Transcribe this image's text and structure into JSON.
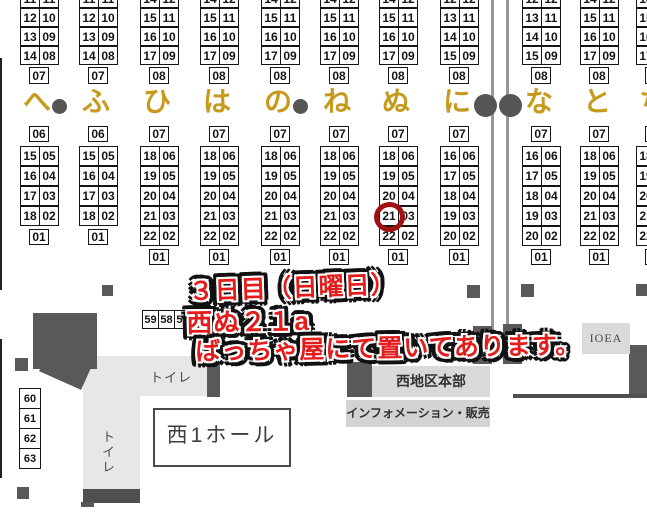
{
  "hall_map": {
    "accent_gold": "#c69b1d",
    "row_labels": [
      {
        "kana": "へ",
        "pillar_dot_after": true
      },
      {
        "kana": "ふ",
        "pillar_dot_after": false
      },
      {
        "kana": "ひ",
        "pillar_dot_after": false
      },
      {
        "kana": "は",
        "pillar_dot_after": false
      },
      {
        "kana": "の",
        "pillar_dot_after": true
      },
      {
        "kana": "ね",
        "pillar_dot_after": false
      },
      {
        "kana": "ぬ",
        "pillar_dot_after": false
      },
      {
        "kana": "に",
        "pillar_dot_after": false
      },
      {
        "kana": "な",
        "pillar_dot_after": false
      },
      {
        "kana": "と",
        "pillar_dot_after": false
      },
      {
        "kana": "ち",
        "pillar_dot_after": false
      }
    ],
    "columns": [
      {
        "kana": "へ",
        "upper": {
          "cut_pair": [
            "11",
            "11"
          ],
          "pairs": [
            [
              "12",
              "10"
            ],
            [
              "13",
              "09"
            ],
            [
              "14",
              "08"
            ]
          ],
          "foot": "07"
        },
        "lower": {
          "head": "06",
          "pairs": [
            [
              "15",
              "05"
            ],
            [
              "16",
              "04"
            ],
            [
              "17",
              "03"
            ],
            [
              "18",
              "02"
            ]
          ],
          "foot": "01"
        }
      },
      {
        "kana": "ふ",
        "upper": {
          "cut_pair": [
            "11",
            "11"
          ],
          "pairs": [
            [
              "12",
              "10"
            ],
            [
              "13",
              "09"
            ],
            [
              "14",
              "08"
            ]
          ],
          "foot": "07"
        },
        "lower": {
          "head": "06",
          "pairs": [
            [
              "15",
              "05"
            ],
            [
              "16",
              "04"
            ],
            [
              "17",
              "03"
            ],
            [
              "18",
              "02"
            ]
          ],
          "foot": "01"
        }
      },
      {
        "kana": "ひ",
        "upper": {
          "cut_pair": [
            "14",
            "12"
          ],
          "pairs": [
            [
              "15",
              "11"
            ],
            [
              "16",
              "10"
            ],
            [
              "17",
              "09"
            ]
          ],
          "foot": "08"
        },
        "lower": {
          "head": "07",
          "pairs": [
            [
              "18",
              "06"
            ],
            [
              "19",
              "05"
            ],
            [
              "20",
              "04"
            ],
            [
              "21",
              "03"
            ],
            [
              "22",
              "02"
            ]
          ],
          "foot": "01"
        }
      },
      {
        "kana": "は",
        "upper": {
          "cut_pair": [
            "14",
            "12"
          ],
          "pairs": [
            [
              "15",
              "11"
            ],
            [
              "16",
              "10"
            ],
            [
              "17",
              "09"
            ]
          ],
          "foot": "08"
        },
        "lower": {
          "head": "07",
          "pairs": [
            [
              "18",
              "06"
            ],
            [
              "19",
              "05"
            ],
            [
              "20",
              "04"
            ],
            [
              "21",
              "03"
            ],
            [
              "22",
              "02"
            ]
          ],
          "foot": "01"
        }
      },
      {
        "kana": "の",
        "upper": {
          "cut_pair": [
            "14",
            "12"
          ],
          "pairs": [
            [
              "15",
              "11"
            ],
            [
              "16",
              "10"
            ],
            [
              "17",
              "09"
            ]
          ],
          "foot": "08"
        },
        "lower": {
          "head": "07",
          "pairs": [
            [
              "18",
              "06"
            ],
            [
              "19",
              "05"
            ],
            [
              "20",
              "04"
            ],
            [
              "21",
              "03"
            ],
            [
              "22",
              "02"
            ]
          ],
          "foot": "01"
        }
      },
      {
        "kana": "ね",
        "upper": {
          "cut_pair": [
            "14",
            "12"
          ],
          "pairs": [
            [
              "15",
              "11"
            ],
            [
              "16",
              "10"
            ],
            [
              "17",
              "09"
            ]
          ],
          "foot": "08"
        },
        "lower": {
          "head": "07",
          "pairs": [
            [
              "18",
              "06"
            ],
            [
              "19",
              "05"
            ],
            [
              "20",
              "04"
            ],
            [
              "21",
              "03"
            ],
            [
              "22",
              "02"
            ]
          ],
          "foot": "01"
        }
      },
      {
        "kana": "ぬ",
        "upper": {
          "cut_pair": [
            "14",
            "12"
          ],
          "pairs": [
            [
              "15",
              "11"
            ],
            [
              "16",
              "10"
            ],
            [
              "17",
              "09"
            ]
          ],
          "foot": "08"
        },
        "lower": {
          "head": "07",
          "pairs": [
            [
              "18",
              "06"
            ],
            [
              "19",
              "05"
            ],
            [
              "20",
              "04"
            ],
            [
              "21",
              "03"
            ],
            [
              "22",
              "02"
            ]
          ],
          "foot": "01"
        }
      },
      {
        "kana": "に",
        "upper": {
          "cut_pair": [
            "12",
            "12"
          ],
          "pairs": [
            [
              "13",
              "11"
            ],
            [
              "14",
              "10"
            ],
            [
              "15",
              "09"
            ]
          ],
          "foot": "08"
        },
        "lower": {
          "head": "07",
          "pairs": [
            [
              "16",
              "06"
            ],
            [
              "17",
              "05"
            ],
            [
              "18",
              "04"
            ],
            [
              "19",
              "03"
            ],
            [
              "20",
              "02"
            ]
          ],
          "foot": "01"
        }
      },
      {
        "kana": "な",
        "upper": {
          "cut_pair": [
            "12",
            "12"
          ],
          "pairs": [
            [
              "13",
              "11"
            ],
            [
              "14",
              "10"
            ],
            [
              "15",
              "09"
            ]
          ],
          "foot": "08"
        },
        "lower": {
          "head": "07",
          "pairs": [
            [
              "16",
              "06"
            ],
            [
              "17",
              "05"
            ],
            [
              "18",
              "04"
            ],
            [
              "19",
              "03"
            ],
            [
              "20",
              "02"
            ]
          ],
          "foot": "01"
        }
      },
      {
        "kana": "と",
        "upper": {
          "cut_pair": [
            "14",
            "12"
          ],
          "pairs": [
            [
              "15",
              "11"
            ],
            [
              "16",
              "10"
            ],
            [
              "17",
              "09"
            ]
          ],
          "foot": "08"
        },
        "lower": {
          "head": "07",
          "pairs": [
            [
              "18",
              "06"
            ],
            [
              "19",
              "05"
            ],
            [
              "20",
              "04"
            ],
            [
              "21",
              "03"
            ],
            [
              "22",
              "02"
            ]
          ],
          "foot": "01"
        }
      },
      {
        "kana": "ち",
        "upper": {
          "cut_pair": [
            "14",
            "12"
          ],
          "pairs": [
            [
              "15",
              "11"
            ],
            [
              "16",
              "10"
            ],
            [
              "17",
              "09"
            ]
          ],
          "foot": "08"
        },
        "lower": {
          "head": "07",
          "pairs": [
            [
              "18",
              "06"
            ],
            [
              "19",
              "05"
            ],
            [
              "20",
              "04"
            ],
            [
              "21",
              "03"
            ],
            [
              "22",
              "02"
            ]
          ],
          "foot": "01"
        }
      }
    ],
    "side_cells_row": [
      "59",
      "58",
      "57"
    ],
    "side_cells_column": [
      "60",
      "61",
      "62",
      "63"
    ],
    "highlight": {
      "column": "ぬ",
      "booth": "21",
      "circle_color": "#a01111"
    }
  },
  "annotation": {
    "color": "#e31c1c",
    "lines": [
      "３日目（日曜日）",
      "西ぬ２１a",
      "ばっちゃ屋にて置いてあります。"
    ]
  },
  "facilities": {
    "hall_name": "西1ホール",
    "toilet_top": "トイレ",
    "toilet_side": "トイレ",
    "hq": "西地区本部",
    "info_desk": "インフォメーション・販売",
    "ioea": "IOEA"
  }
}
